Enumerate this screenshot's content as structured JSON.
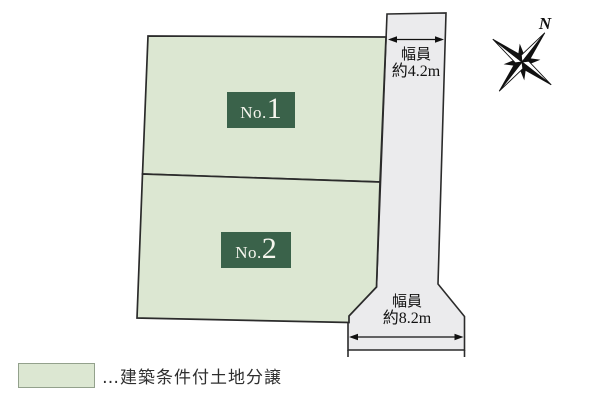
{
  "plots": [
    {
      "prefix": "No.",
      "number": "1"
    },
    {
      "prefix": "No.",
      "number": "2"
    }
  ],
  "dimensions": {
    "right_road": {
      "label": "幅員",
      "value": "約4.2m"
    },
    "bottom_road": {
      "label": "幅員",
      "value": "約8.2m"
    }
  },
  "compass": {
    "north_label": "N"
  },
  "legend": {
    "label": "…建築条件付土地分譲"
  },
  "colors": {
    "plot_fill": "#dce7d2",
    "plot_border": "#2b2b2b",
    "road_fill": "#ebebed",
    "label_box": "#3a624a",
    "label_text": "#f6f6ee",
    "dimension_text": "#111111",
    "legend_text": "#2e2e2e",
    "legend_border": "#93a18c"
  }
}
